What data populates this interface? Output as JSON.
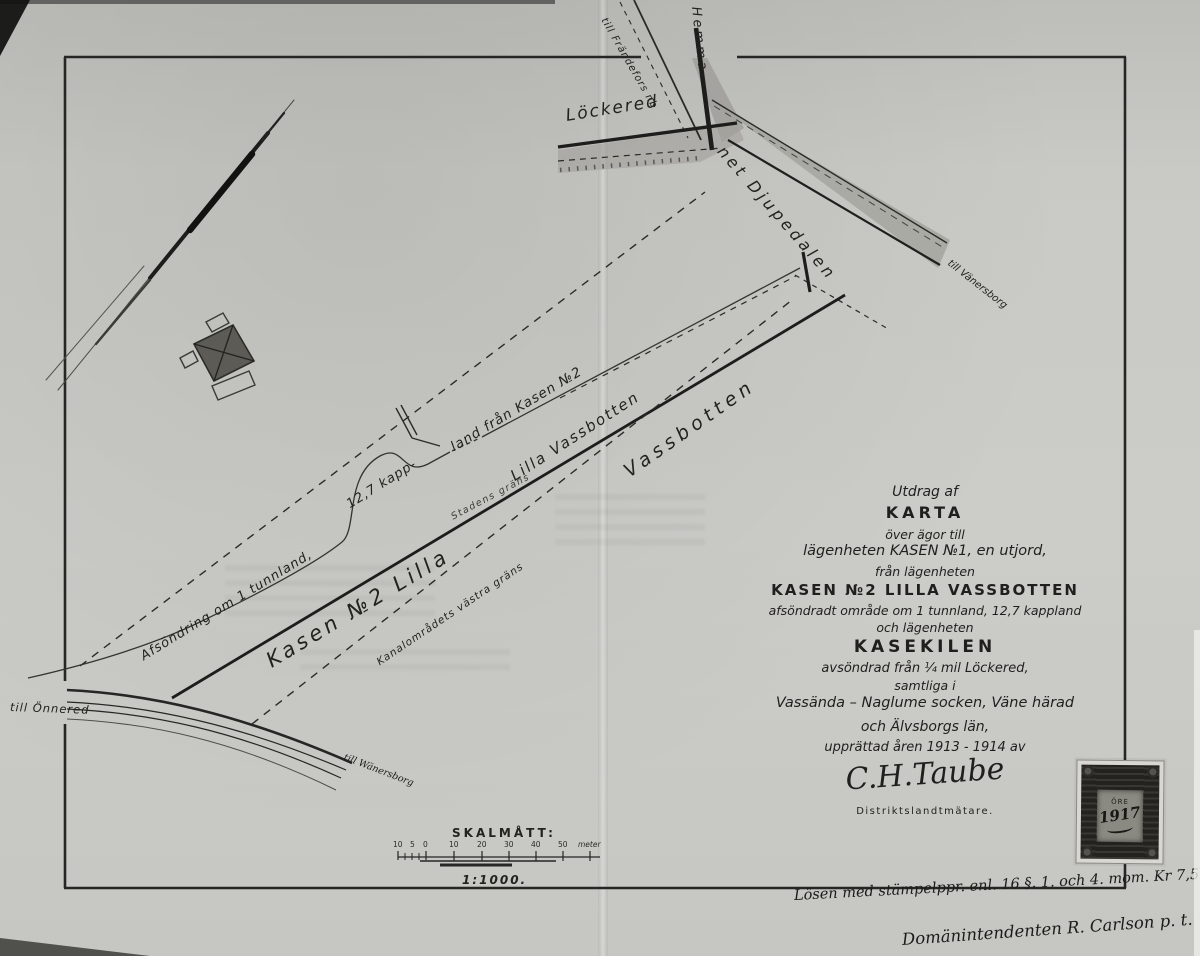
{
  "map_labels": {
    "lockered": "Löckered",
    "till_frandefors": "till Frändefors nb",
    "hemma": "Hemma-",
    "net_djupedalen": "net Djupedalen",
    "till_vanersborg_ne": "till Vänersborg",
    "till_onnered": "till Önnered",
    "till_wanersborg_sw": "till Wänersborg",
    "afsondring": "Afsöndring om 1 tunnland,",
    "kapp": "12,7 kapp-",
    "land_fran_kasen": "land från Kasen №2",
    "lilla_vassbotten": "Lilla Vassbotten",
    "vassbotten": "Vassbotten",
    "kasen_2_lilla": "Kasen №2 Lilla",
    "stadens_grans": "Stadens gräns",
    "kanalomradets": "Kanalområdets västra gräns"
  },
  "title_block": {
    "line1": "Utdrag af",
    "line2": "KARTA",
    "line3": "över ägor till",
    "line4": "lägenheten  KASEN №1, en utjord,",
    "line5": "från lägenheten",
    "line6": "KASEN №2 LILLA VASSBOTTEN",
    "line7": "afsöndradt område om 1 tunnland, 12,7 kappland",
    "line8": "och lägenheten",
    "line9": "KASEKILEN",
    "line10": "avsöndrad från ¼ mil Löckered,",
    "line11": "samtliga i",
    "line12": "Vassända – Naglume socken, Väne härad",
    "line13": "och Älvsborgs län,",
    "line14": "upprättad åren 1913 - 1914 av",
    "signature": "C.H.Taube",
    "signature_title": "Distriktslandtmätare."
  },
  "scale": {
    "title": "SKALMÅTT:",
    "ratio": "1:1000.",
    "ticks": [
      "10",
      "5",
      "0",
      "10",
      "20",
      "30",
      "40",
      "50"
    ],
    "unit": "meter"
  },
  "annotations": {
    "losen": "Lösen med stämpelppr. enl. 16 §. 1. och 4. mom. Kr 7,50.",
    "surveyor": "Domänintendenten R. Carlson p. t."
  },
  "stamp": {
    "text1": "ÖRE",
    "text2": "1917"
  },
  "colors": {
    "paper": "#c9c9c5",
    "ink": "#1f1f1d",
    "road_fill": "#9d9d98"
  }
}
